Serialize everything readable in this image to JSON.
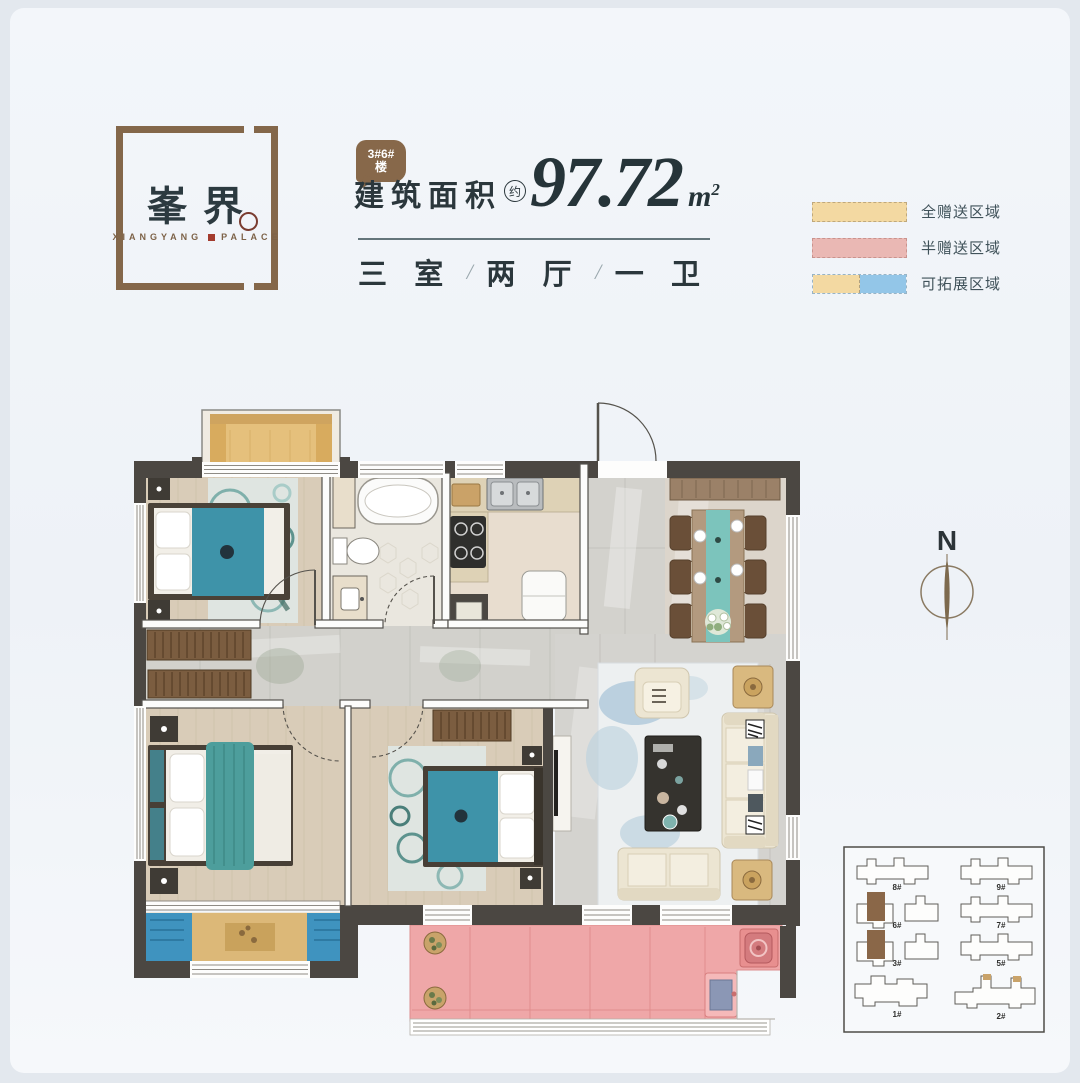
{
  "page": {
    "background": "#e3e8ee",
    "card_background": "#f2f5f9"
  },
  "brand": {
    "name": "峯界",
    "latin_prefix": "XIANGYANG",
    "latin_suffix": "PALACE"
  },
  "unit_badge": {
    "line1": "3#6#",
    "line2": "楼"
  },
  "area": {
    "label": "建筑面积",
    "approx": "约",
    "value": "97.72",
    "unit": "m",
    "unit_exponent": "2"
  },
  "layout_spec": {
    "parts": [
      "三 室",
      "两 厅",
      "一 卫"
    ],
    "separator": "/"
  },
  "legend": {
    "items": [
      {
        "label": "全赠送区域",
        "style": "yellow"
      },
      {
        "label": "半赠送区域",
        "style": "pink"
      },
      {
        "label": "可拓展区域",
        "style": "dual"
      }
    ]
  },
  "compass": {
    "north_label": "N"
  },
  "site_plan": {
    "buildings": [
      {
        "id": "8#",
        "highlighted": false
      },
      {
        "id": "9#",
        "highlighted": false
      },
      {
        "id": "6#",
        "highlighted": true
      },
      {
        "id": "7#",
        "highlighted": false
      },
      {
        "id": "3#",
        "highlighted": true
      },
      {
        "id": "5#",
        "highlighted": false
      },
      {
        "id": "1#",
        "highlighted": false
      },
      {
        "id": "2#",
        "highlighted": false
      }
    ]
  },
  "colors": {
    "accent_brown": "#84674a",
    "dark_text": "#2b373c",
    "wall": "#4b4742",
    "plan_pink": "#ef9d9d",
    "legend_yellow": "#f3d9a2",
    "legend_pink": "#eab8b4",
    "legend_blue": "#93c6e8"
  }
}
